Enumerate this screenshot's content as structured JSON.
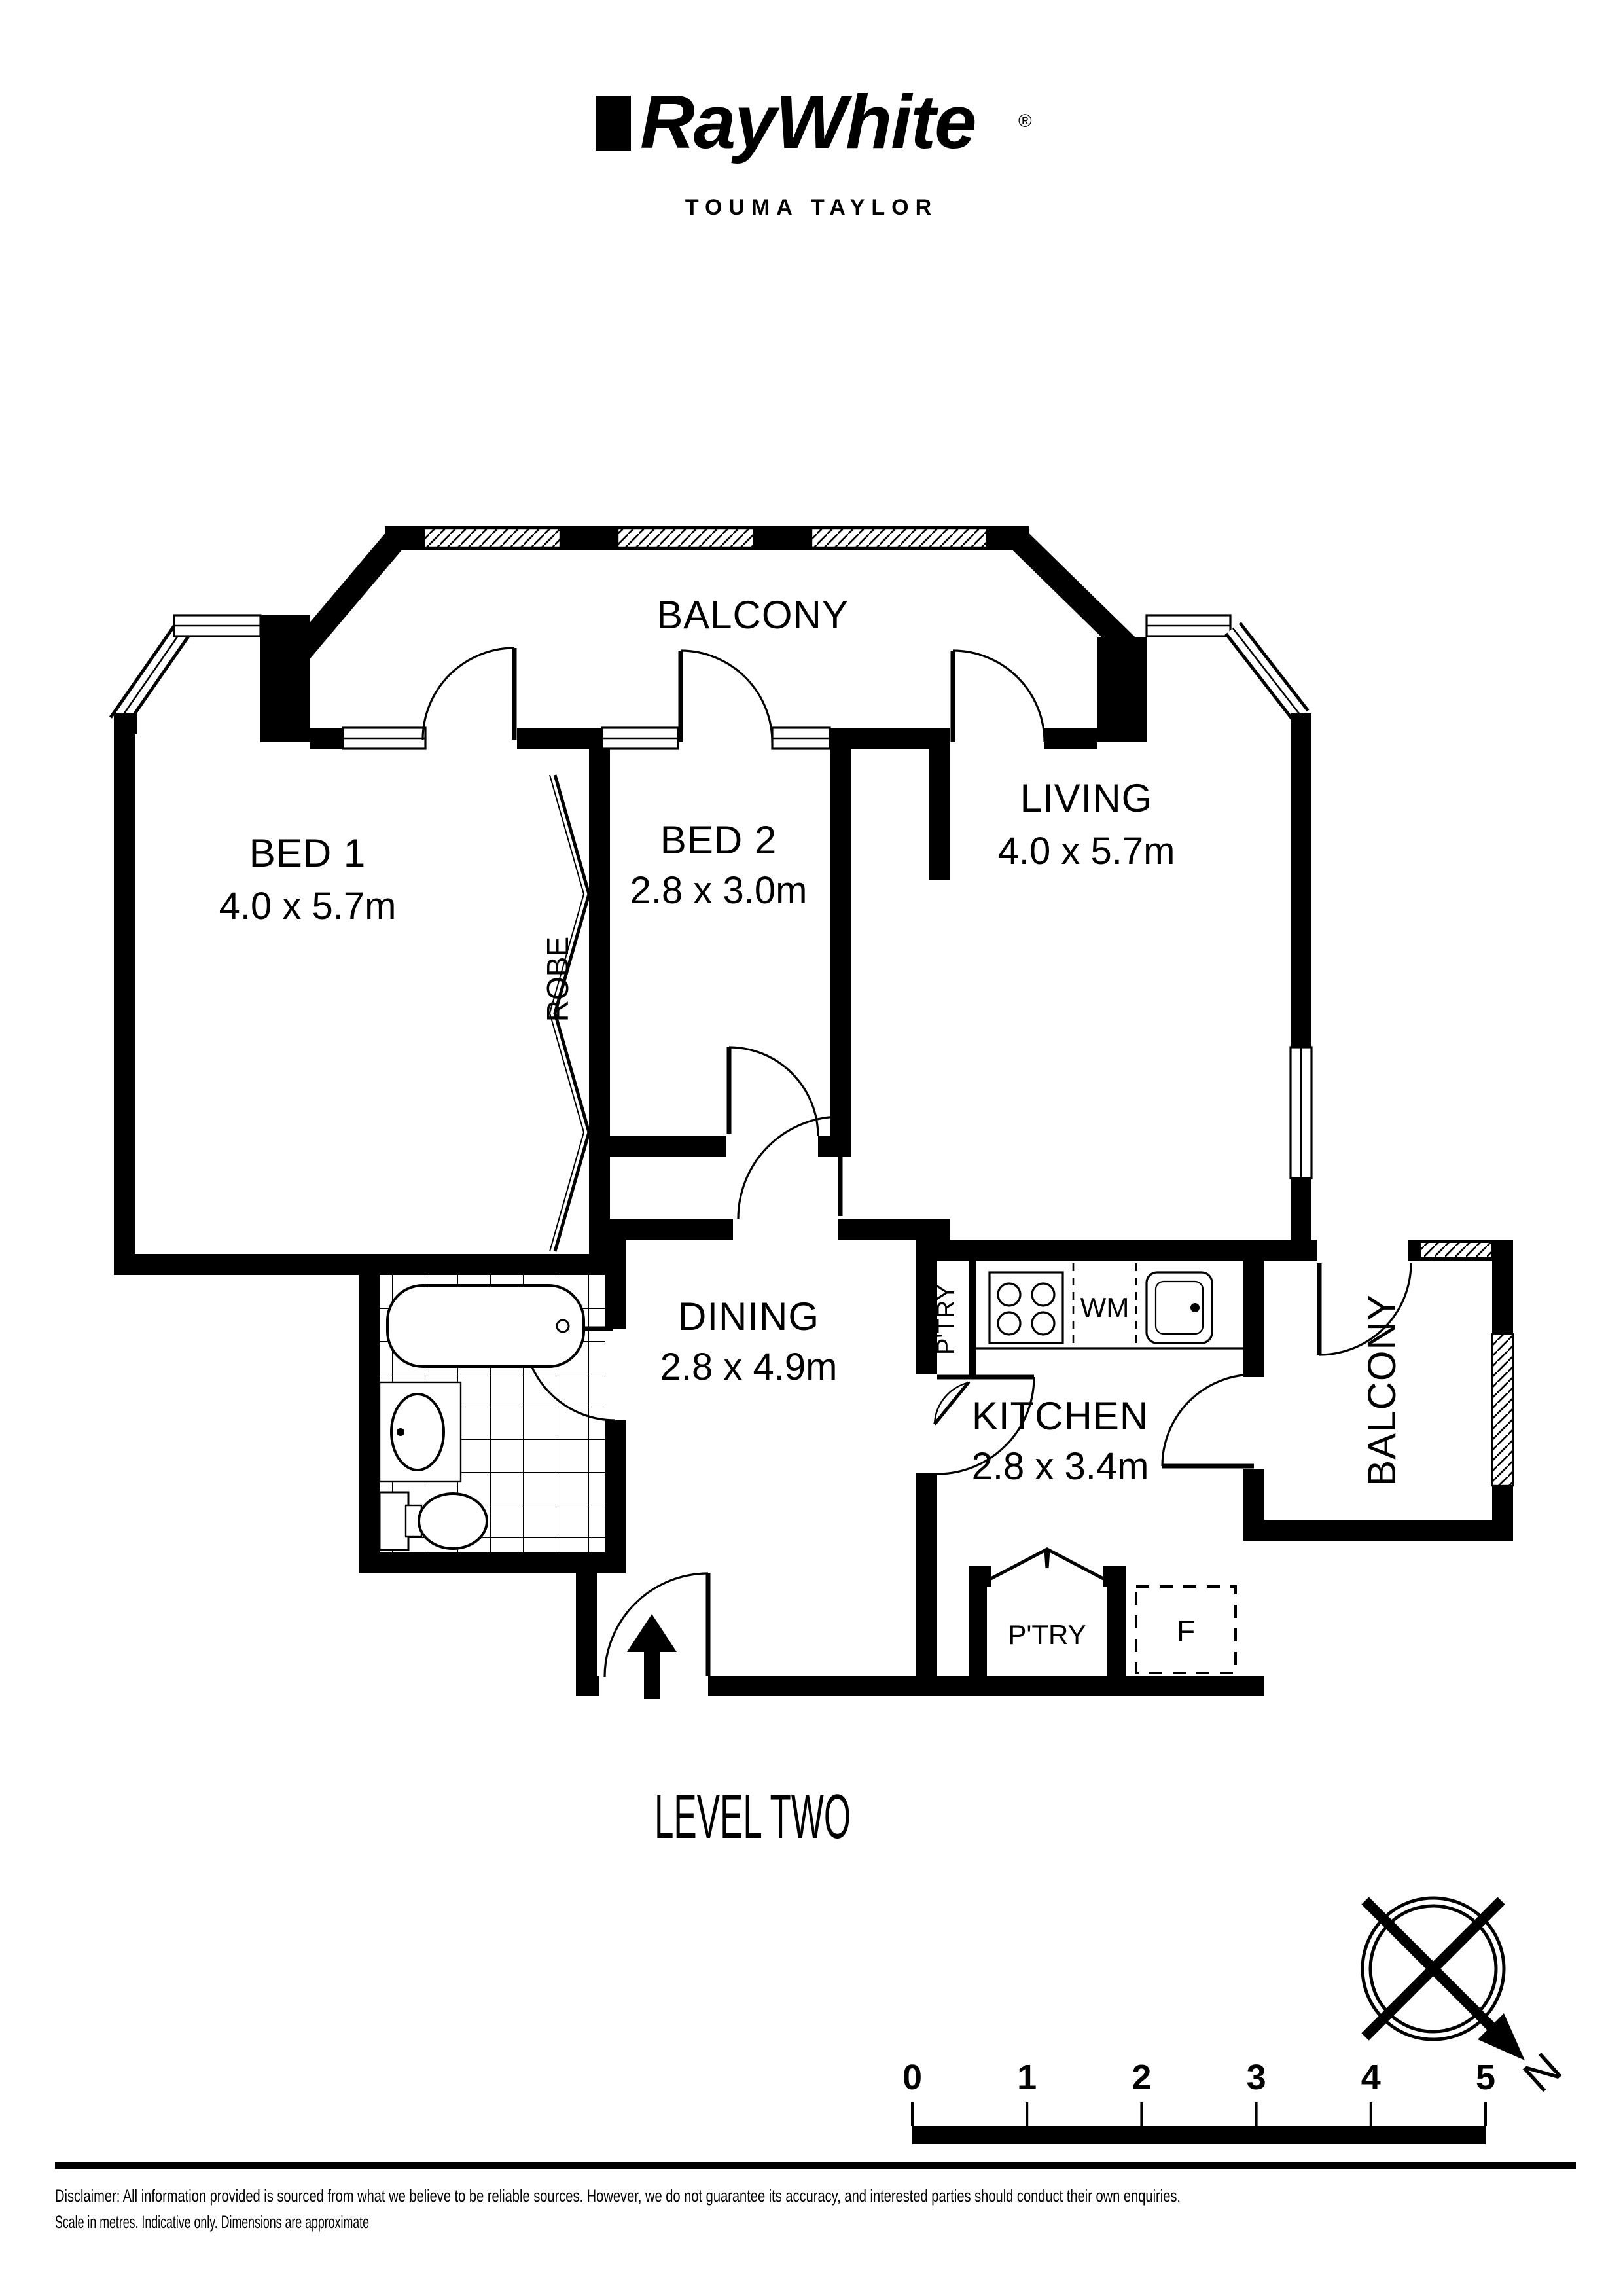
{
  "brand": {
    "name": "RayWhite",
    "registered": "®",
    "office": "TOUMA TAYLOR"
  },
  "rooms": {
    "balcony_top": {
      "name": "BALCONY"
    },
    "bed1": {
      "name": "BED 1",
      "dims": "4.0 x 5.7m"
    },
    "bed2": {
      "name": "BED 2",
      "dims": "2.8 x 3.0m"
    },
    "robe": {
      "name": "ROBE"
    },
    "living": {
      "name": "LIVING",
      "dims": "4.0 x 5.7m"
    },
    "dining": {
      "name": "DINING",
      "dims": "2.8 x 4.9m"
    },
    "kitchen": {
      "name": "KITCHEN",
      "dims": "2.8 x 3.4m"
    },
    "pantry_kitchen": {
      "name": "P'TRY"
    },
    "pantry_closet": {
      "name": "P'TRY"
    },
    "balcony_right": {
      "name": "BALCONY"
    }
  },
  "fixtures": {
    "washing_machine": "WM",
    "fridge": "F"
  },
  "level_label": "LEVEL TWO",
  "compass": {
    "north": "N"
  },
  "scale_bar": {
    "ticks": [
      "0",
      "1",
      "2",
      "3",
      "4",
      "5"
    ]
  },
  "footer": {
    "line1": "Disclaimer: All information provided is sourced from what we believe to be reliable sources. However, we do not guarantee  its accuracy, and interested parties should conduct their own enquiries.",
    "line2": "Scale in metres. Indicative only. Dimensions are approximate"
  },
  "colors": {
    "ink": "#000000",
    "paper": "#ffffff"
  }
}
